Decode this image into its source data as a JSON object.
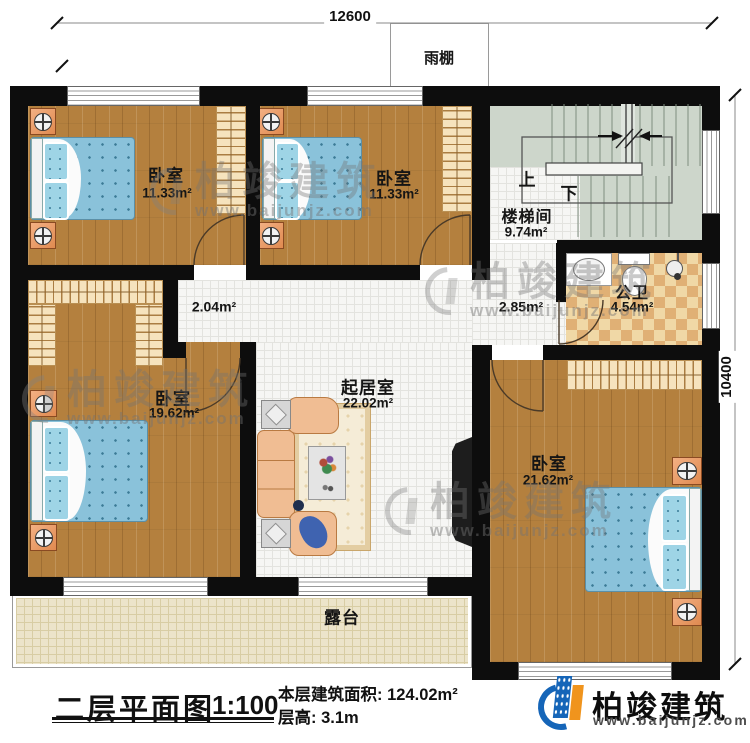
{
  "dimensions": {
    "width_mm": "12600",
    "height_mm": "10400"
  },
  "canopy": {
    "label": "雨棚"
  },
  "rooms": {
    "bedroom_top_left": {
      "label": "卧室",
      "area": "11.33m²"
    },
    "bedroom_top_mid": {
      "label": "卧室",
      "area": "11.33m²"
    },
    "bedroom_left": {
      "label": "卧室",
      "area": "19.62m²"
    },
    "bedroom_right": {
      "label": "卧室",
      "area": "21.62m²"
    },
    "stairwell": {
      "label": "楼梯间",
      "area": "9.74m²",
      "up": "上",
      "down": "下"
    },
    "bathroom": {
      "label": "公卫",
      "area": "4.54m²"
    },
    "living": {
      "label": "起居室",
      "area": "22.02m²"
    },
    "hall_left": {
      "area": "2.04m²"
    },
    "hall_right": {
      "area": "2.85m²"
    },
    "terrace": {
      "label": "露台"
    }
  },
  "title_block": {
    "title": "二层平面图",
    "scale": "1:100",
    "floor_area": "本层建筑面积: 124.02m²",
    "floor_height": "层高: 3.1m"
  },
  "logo": {
    "name": "柏竣建筑",
    "url": "www.baijunjz.com"
  },
  "watermark": {
    "name": "柏竣建筑",
    "url": "www.baijunjz.com"
  },
  "colors": {
    "wall": "#0d0d0d",
    "wood": "#b4803e",
    "tile": "#f6f6f4",
    "stair": "#cdd6cb",
    "terrace": "#ece4ca",
    "checker_light": "#f0d8a6",
    "checker_dark": "#e0b075",
    "bed": "#8ac2da",
    "sofa": "#f0bd93",
    "nightstand": "#e08a50",
    "logo_blue": "#1565b8",
    "logo_orange": "#f0941d"
  }
}
